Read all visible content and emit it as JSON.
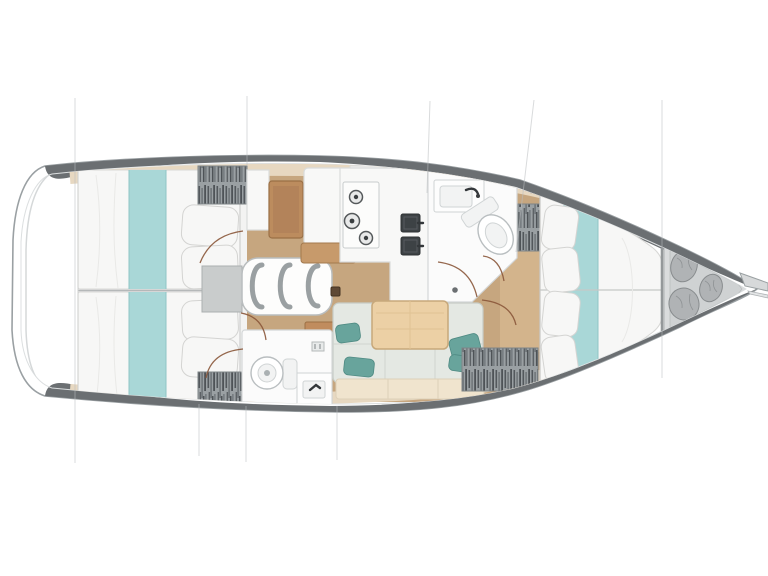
{
  "meta": {
    "title": "Sailing yacht interior layout — top-view floor plan",
    "view": "top-down",
    "orientation": "bow-right"
  },
  "canvas": {
    "width": 768,
    "height": 576,
    "background": "#ffffff"
  },
  "palette": {
    "hull_outline": "#9aa0a3",
    "deck_band": "#6b6f72",
    "side_deck": "#e7d8c1",
    "sole_wood": "#c6a67f",
    "sole_wood_light": "#d3b48c",
    "bed_linen": "#f7f7f6",
    "runner_teal": "#a9d7d7",
    "cushion_gray": "#e4e8e3",
    "pillow_teal": "#68a49c",
    "table_wood": "#ecd0a5",
    "desk_wood": "#bc8c5e",
    "bench_wood": "#c79a6b",
    "locker_gray": "#9aa0a3",
    "fixture_white": "#fbfbfb",
    "sink_dark": "#3d4245",
    "door_arc": "#8a573a",
    "section_line": "#b9bec0",
    "bag_gray": "#b0b3b5",
    "locker_floor": "#dadcdd",
    "background": "#ffffff"
  },
  "features": {
    "double_berths": 3,
    "heads_with_toilet": 2,
    "stove_burners": 3,
    "galley_sinks": 2,
    "companionway_steps": 3,
    "bow_locker_bags": 3,
    "hanging_lockers": 4,
    "salon_tables": 1
  },
  "regions": [
    {
      "name": "stern-transom"
    },
    {
      "name": "aft-cabin-port"
    },
    {
      "name": "aft-cabin-starboard"
    },
    {
      "name": "companionway"
    },
    {
      "name": "nav-station"
    },
    {
      "name": "galley"
    },
    {
      "name": "forward-head"
    },
    {
      "name": "aft-head"
    },
    {
      "name": "salon"
    },
    {
      "name": "forward-cabin"
    },
    {
      "name": "anchor-locker"
    },
    {
      "name": "bowsprit"
    }
  ]
}
